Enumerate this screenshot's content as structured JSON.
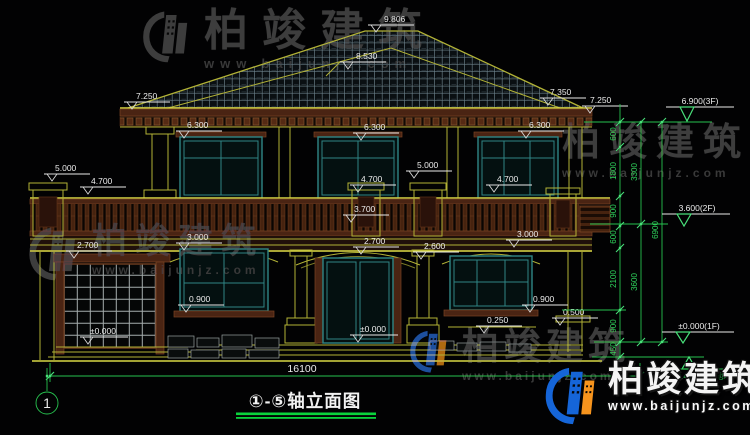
{
  "watermark": {
    "brand": "柏竣建筑",
    "url": "www.baijunjz.com"
  },
  "drawing_colors": {
    "line_yellow": "#b2b236",
    "frame_teal": "#2f8585",
    "wood_brown": "#4a2413",
    "dim_green": "#27c24f",
    "text_white": "#ececec"
  },
  "markers": {
    "ridge": "9.806",
    "upper_hip": "8.530",
    "eave_left": "7.250",
    "eave_right_upper": "7.350",
    "eave_right": "7.250",
    "win_head_left": "6.300",
    "win_head_mid": "6.300",
    "win_head_right": "6.300",
    "pier_left": "5.000",
    "pier_right": "5.000",
    "rail_left": "4.700",
    "rail_mid": "4.700",
    "rail_right": "4.700",
    "balcony_floor": "3.700",
    "band_left": "3.000",
    "band_right": "3.000",
    "arch_left": "2.700",
    "arch_mid": "2.700",
    "arch_right": "2.600",
    "sill_left": "0.900",
    "sill_right": "0.900",
    "zero_left": "±0.000",
    "zero_mid": "±0.000",
    "ledge_right": "0.250",
    "plinth_right": "0.500"
  },
  "right_dims": {
    "f3": "6.900(3F)",
    "f2": "3.600(2F)",
    "f1": "±0.000(1F)",
    "grade": "-0.450(室外地坪)",
    "chain_a": [
      "600",
      "1800",
      "900",
      "600",
      "2100",
      "900",
      "450"
    ],
    "chain_b": [
      "3300",
      "3600"
    ],
    "chain_c": [
      "6900"
    ]
  },
  "bottom": {
    "total_width": "16100",
    "axis_start": "1",
    "title": "①-⑤轴立面图"
  }
}
